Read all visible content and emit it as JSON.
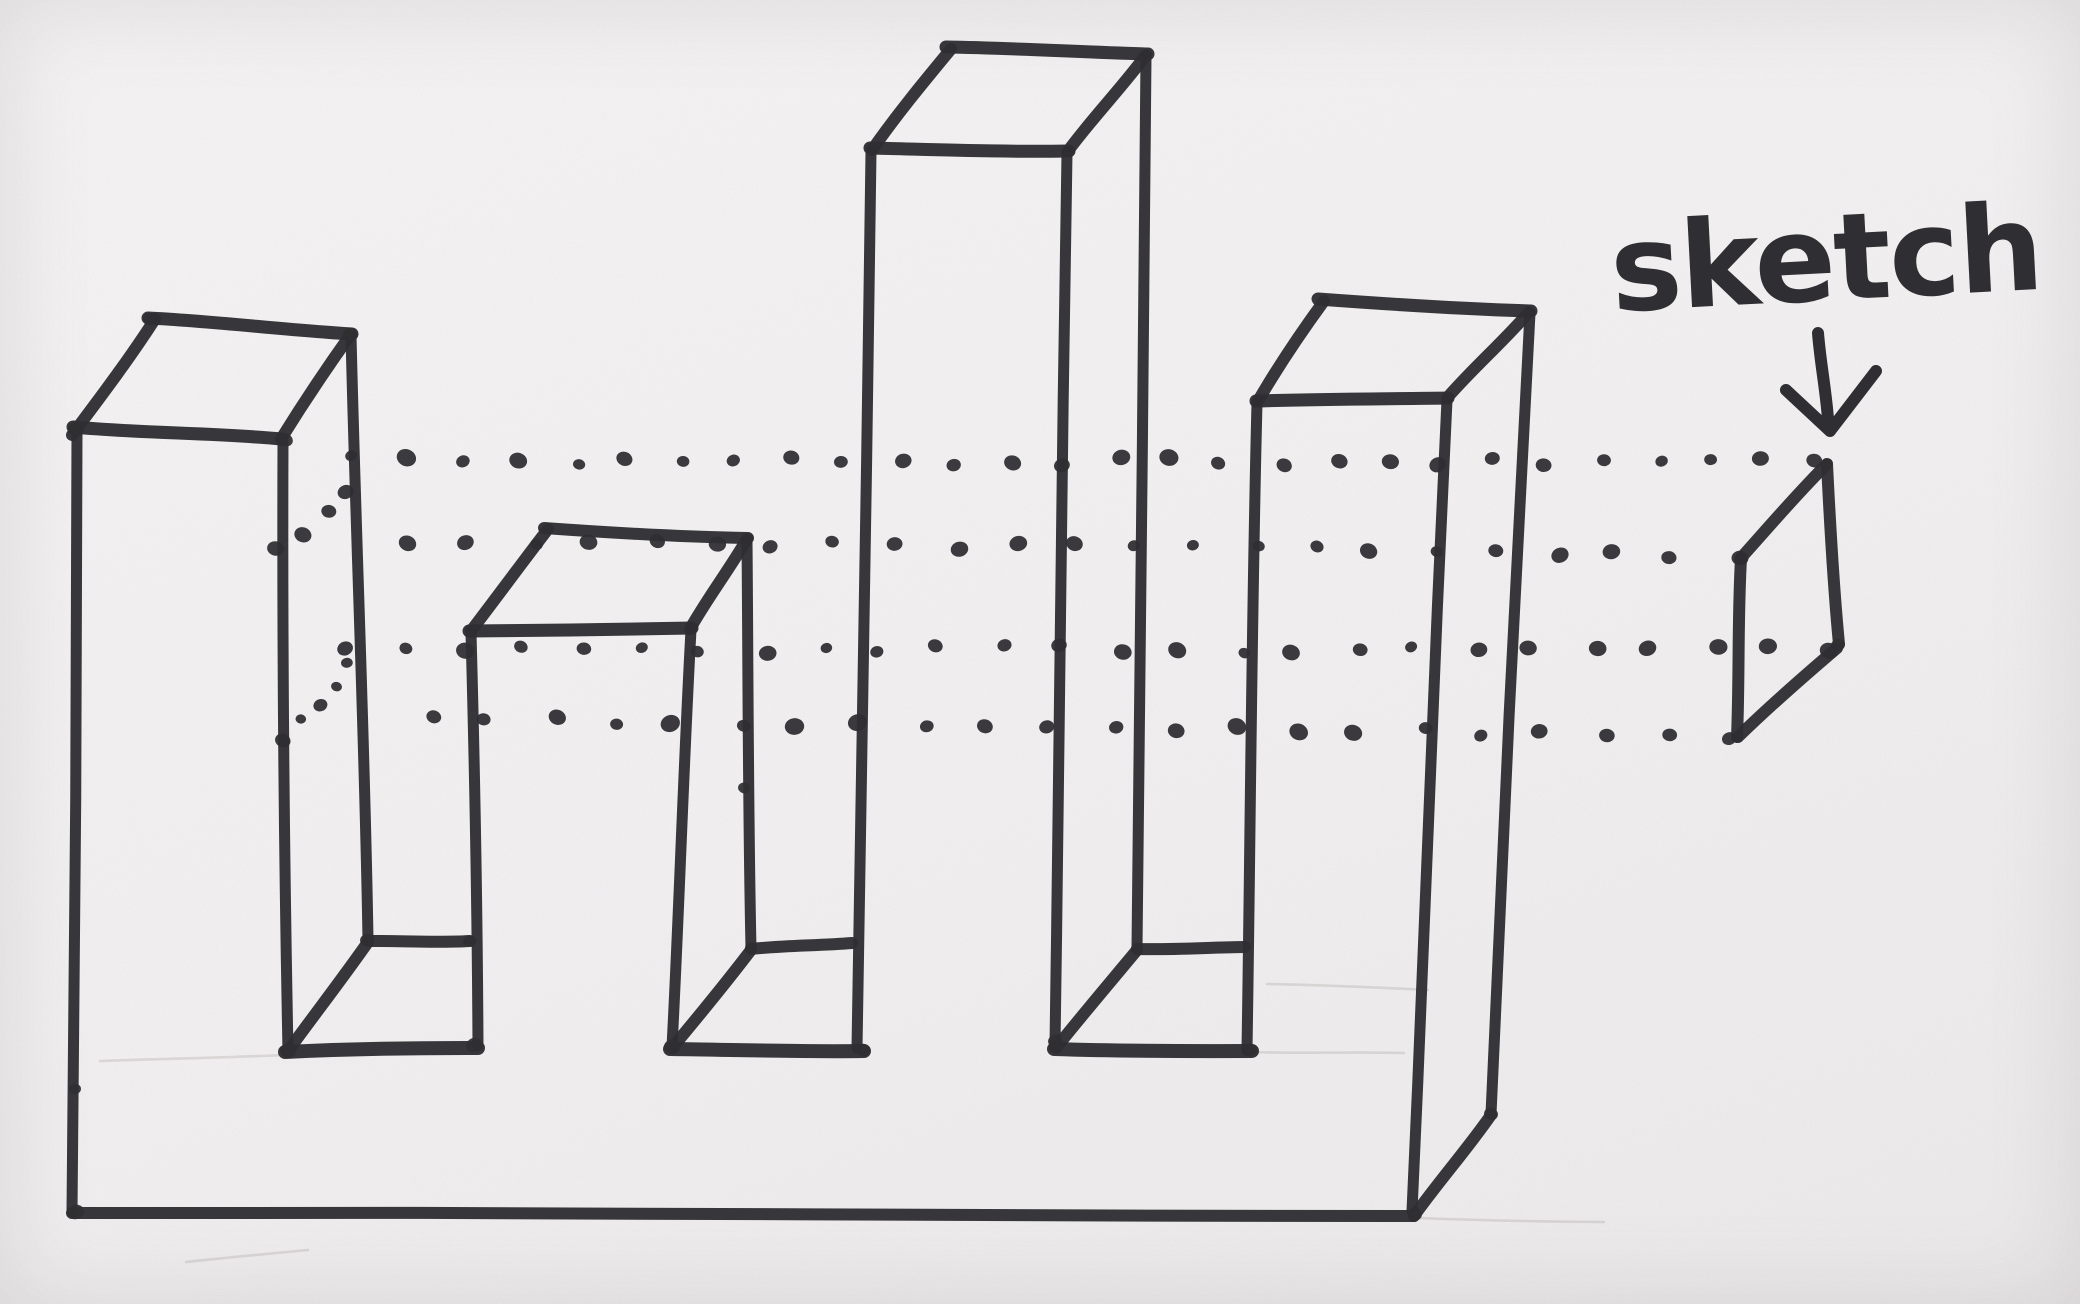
{
  "label": {
    "text": "sketch"
  },
  "colors": {
    "ink": "#2f2e32",
    "paper": "#f1eff0",
    "pencil": "#8d8781"
  },
  "drawing": {
    "width": 2080,
    "height": 1304,
    "strokes": [
      {
        "name": "tower1-top-front-edge",
        "pts": [
          [
            73,
            427
          ],
          [
            282,
            439
          ]
        ],
        "w": 13
      },
      {
        "name": "tower1-top-left-depth-edge",
        "pts": [
          [
            72,
            435
          ],
          [
            155,
            319
          ]
        ],
        "w": 12
      },
      {
        "name": "tower1-top-back-edge",
        "pts": [
          [
            148,
            318
          ],
          [
            352,
            334
          ]
        ],
        "w": 13
      },
      {
        "name": "tower1-top-right-depth-edge",
        "pts": [
          [
            281,
            439
          ],
          [
            351,
            334
          ]
        ],
        "w": 12
      },
      {
        "name": "tower1-left-vertical-edge",
        "pts": [
          [
            77,
            431
          ],
          [
            72,
            1212
          ]
        ],
        "w": 11
      },
      {
        "name": "tower1-front-right-vertical-edge",
        "pts": [
          [
            283,
            441
          ],
          [
            288,
            1051
          ]
        ],
        "w": 11
      },
      {
        "name": "tower1-back-right-vertical-edge",
        "pts": [
          [
            351,
            335
          ],
          [
            368,
            940
          ]
        ],
        "w": 11
      },
      {
        "name": "tower2-top-front-edge",
        "pts": [
          [
            469,
            631
          ],
          [
            692,
            628
          ]
        ],
        "w": 13
      },
      {
        "name": "tower2-top-left-depth-edge",
        "pts": [
          [
            471,
            631
          ],
          [
            548,
            529
          ]
        ],
        "w": 12
      },
      {
        "name": "tower2-top-back-edge",
        "pts": [
          [
            544,
            528
          ],
          [
            748,
            538
          ]
        ],
        "w": 12
      },
      {
        "name": "tower2-top-right-depth-edge",
        "pts": [
          [
            690,
            629
          ],
          [
            747,
            539
          ]
        ],
        "w": 12
      },
      {
        "name": "tower2-front-left-vertical-edge",
        "pts": [
          [
            471,
            633
          ],
          [
            478,
            1046
          ]
        ],
        "w": 11
      },
      {
        "name": "tower2-front-right-vertical-edge",
        "pts": [
          [
            691,
            630
          ],
          [
            672,
            1047
          ]
        ],
        "w": 11
      },
      {
        "name": "tower2-back-right-vertical-edge",
        "pts": [
          [
            747,
            540
          ],
          [
            751,
            948
          ]
        ],
        "w": 11
      },
      {
        "name": "tower3-top-front-edge",
        "pts": [
          [
            870,
            148
          ],
          [
            1069,
            151
          ]
        ],
        "w": 13
      },
      {
        "name": "tower3-top-left-depth-edge",
        "pts": [
          [
            872,
            150
          ],
          [
            951,
            49
          ]
        ],
        "w": 12
      },
      {
        "name": "tower3-top-back-edge",
        "pts": [
          [
            946,
            47
          ],
          [
            1148,
            54
          ]
        ],
        "w": 13
      },
      {
        "name": "tower3-top-right-depth-edge",
        "pts": [
          [
            1068,
            151
          ],
          [
            1146,
            55
          ]
        ],
        "w": 12
      },
      {
        "name": "tower3-front-left-vertical-edge",
        "pts": [
          [
            871,
            152
          ],
          [
            857,
            1048
          ]
        ],
        "w": 11
      },
      {
        "name": "tower3-front-right-vertical-edge",
        "pts": [
          [
            1067,
            153
          ],
          [
            1055,
            1045
          ]
        ],
        "w": 11
      },
      {
        "name": "tower3-back-right-vertical-edge",
        "pts": [
          [
            1146,
            56
          ],
          [
            1137,
            948
          ]
        ],
        "w": 11
      },
      {
        "name": "tower4-top-front-edge",
        "pts": [
          [
            1256,
            401
          ],
          [
            1448,
            398
          ]
        ],
        "w": 13
      },
      {
        "name": "tower4-top-left-depth-edge",
        "pts": [
          [
            1258,
            401
          ],
          [
            1324,
            301
          ]
        ],
        "w": 12
      },
      {
        "name": "tower4-top-back-edge",
        "pts": [
          [
            1318,
            299
          ],
          [
            1531,
            311
          ]
        ],
        "w": 13
      },
      {
        "name": "tower4-top-right-depth-edge",
        "pts": [
          [
            1447,
            398
          ],
          [
            1529,
            312
          ]
        ],
        "w": 12
      },
      {
        "name": "tower4-front-left-vertical-edge",
        "pts": [
          [
            1257,
            403
          ],
          [
            1247,
            1050
          ]
        ],
        "w": 11
      },
      {
        "name": "tower4-front-right-vertical-edge",
        "pts": [
          [
            1447,
            400
          ],
          [
            1412,
            1211
          ]
        ],
        "w": 11
      },
      {
        "name": "tower4-back-right-vertical-edge",
        "pts": [
          [
            1530,
            313
          ],
          [
            1491,
            1114
          ]
        ],
        "w": 11
      },
      {
        "name": "notch1-back-bottom-edge",
        "pts": [
          [
            368,
            941
          ],
          [
            470,
            941
          ]
        ],
        "w": 12
      },
      {
        "name": "notch1-front-bottom-edge",
        "pts": [
          [
            285,
            1052
          ],
          [
            478,
            1048
          ]
        ],
        "w": 14
      },
      {
        "name": "notch1-depth-diagonal-edge",
        "pts": [
          [
            288,
            1051
          ],
          [
            368,
            942
          ]
        ],
        "w": 12
      },
      {
        "name": "notch2-back-bottom-edge",
        "pts": [
          [
            751,
            949
          ],
          [
            852,
            943
          ]
        ],
        "w": 12
      },
      {
        "name": "notch2-front-bottom-edge",
        "pts": [
          [
            670,
            1049
          ],
          [
            864,
            1051
          ]
        ],
        "w": 14
      },
      {
        "name": "notch2-depth-diagonal-edge",
        "pts": [
          [
            672,
            1048
          ],
          [
            751,
            950
          ]
        ],
        "w": 12
      },
      {
        "name": "notch3-back-bottom-edge",
        "pts": [
          [
            1137,
            949
          ],
          [
            1245,
            947
          ]
        ],
        "w": 12
      },
      {
        "name": "notch3-front-bottom-edge",
        "pts": [
          [
            1054,
            1049
          ],
          [
            1252,
            1051
          ]
        ],
        "w": 14
      },
      {
        "name": "notch3-depth-diagonal-edge",
        "pts": [
          [
            1056,
            1048
          ],
          [
            1137,
            950
          ]
        ],
        "w": 12
      },
      {
        "name": "base-bottom-front-edge",
        "pts": [
          [
            72,
            1213
          ],
          [
            1414,
            1216
          ]
        ],
        "w": 12
      },
      {
        "name": "base-bottom-right-depth-edge",
        "pts": [
          [
            1414,
            1216
          ],
          [
            1491,
            1115
          ]
        ],
        "w": 12
      },
      {
        "name": "sketch-plane-right-edge",
        "pts": [
          [
            1827,
            464
          ],
          [
            1839,
            644
          ]
        ],
        "w": 12
      },
      {
        "name": "sketch-plane-left-edge",
        "pts": [
          [
            1741,
            559
          ],
          [
            1737,
            737
          ]
        ],
        "w": 12
      },
      {
        "name": "sketch-plane-top-depth-edge",
        "pts": [
          [
            1740,
            559
          ],
          [
            1826,
            465
          ]
        ],
        "w": 12
      },
      {
        "name": "sketch-plane-bottom-depth-edge",
        "pts": [
          [
            1738,
            737
          ],
          [
            1837,
            648
          ]
        ],
        "w": 12
      }
    ],
    "pencil_lines": [
      {
        "name": "guide-left-notch-level",
        "pts": [
          [
            100,
            1061
          ],
          [
            286,
            1055
          ]
        ]
      },
      {
        "name": "guide-right-notch-level",
        "pts": [
          [
            1252,
            1052
          ],
          [
            1404,
            1053
          ]
        ]
      },
      {
        "name": "guide-right-back-level",
        "pts": [
          [
            1267,
            984
          ],
          [
            1428,
            990
          ]
        ]
      },
      {
        "name": "guide-bottom-right",
        "pts": [
          [
            1418,
            1218
          ],
          [
            1604,
            1222
          ]
        ]
      },
      {
        "name": "smudge-bottom-left",
        "pts": [
          [
            186,
            1262
          ],
          [
            308,
            1250
          ]
        ]
      }
    ],
    "dotted_rows": [
      {
        "name": "projection-line-top-back",
        "from": [
          358,
          460
        ],
        "to": [
          1821,
          463
        ],
        "n": 28,
        "r": 8
      },
      {
        "name": "projection-line-top-front",
        "from": [
          412,
          539
        ],
        "to": [
          1735,
          556
        ],
        "n": 23,
        "r": 7.5
      },
      {
        "name": "projection-line-bottom-back",
        "from": [
          346,
          651
        ],
        "to": [
          1832,
          648
        ],
        "n": 26,
        "r": 7.5
      },
      {
        "name": "projection-line-bottom-front",
        "from": [
          428,
          719
        ],
        "to": [
          1732,
          736
        ],
        "n": 22,
        "r": 8
      },
      {
        "name": "side-face-diagonal-upper",
        "from": [
          281,
          552
        ],
        "to": [
          351,
          490
        ],
        "n": 4,
        "r": 7
      },
      {
        "name": "side-face-diagonal-lower",
        "from": [
          283,
          741
        ],
        "to": [
          347,
          666
        ],
        "n": 5,
        "r": 7
      }
    ],
    "blobs": [
      [
        76,
        1212,
        8
      ],
      [
        1415,
        1214,
        7
      ],
      [
        474,
        1045,
        8
      ],
      [
        288,
        1051,
        8
      ],
      [
        672,
        1047,
        8
      ],
      [
        863,
        1050,
        7
      ],
      [
        1250,
        1050,
        7
      ],
      [
        1056,
        1047,
        7
      ],
      [
        744,
        788,
        6
      ],
      [
        75,
        1089,
        6
      ],
      [
        1838,
        645,
        7
      ],
      [
        367,
        940,
        7
      ],
      [
        751,
        948,
        6
      ],
      [
        1137,
        948,
        6
      ],
      [
        1055,
        1041,
        7
      ],
      [
        1491,
        1114,
        7
      ],
      [
        286,
        440,
        7
      ],
      [
        350,
        334,
        7
      ],
      [
        150,
        319,
        7
      ],
      [
        76,
        429,
        8
      ],
      [
        1827,
        464,
        6
      ],
      [
        469,
        941,
        6
      ]
    ],
    "arrow": {
      "shaft": [
        [
          1818,
          333
        ],
        [
          1828,
          419
        ]
      ],
      "head": [
        [
          1786,
          390
        ],
        [
          1830,
          431
        ],
        [
          1876,
          371
        ]
      ],
      "w": 12
    },
    "label_pos": {
      "x": 1828,
      "y": 300,
      "size": 120,
      "rotate": -3
    }
  }
}
